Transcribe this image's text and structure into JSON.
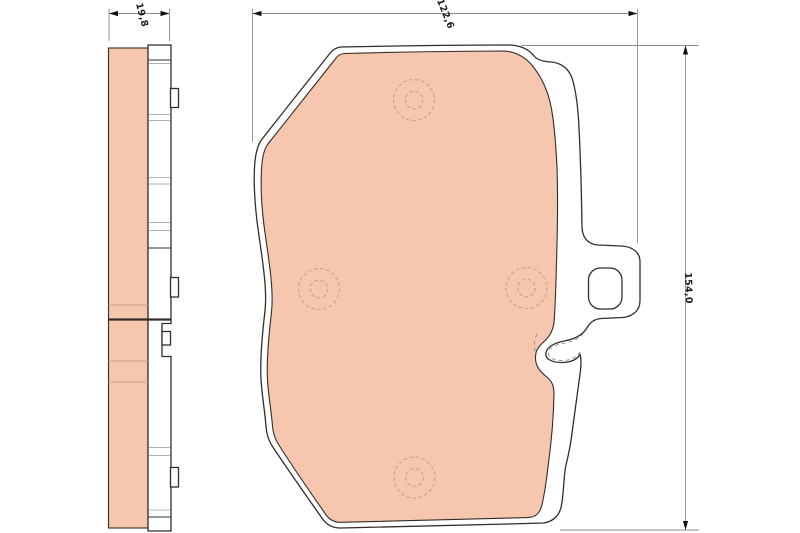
{
  "dimensions": {
    "thickness": {
      "label": "19,8"
    },
    "width": {
      "label": "122,6"
    },
    "height": {
      "label": "154,0"
    }
  },
  "colors": {
    "friction_material": "#f6c7ae",
    "outline": "#332d28",
    "dimension_line": "#8d8d8d",
    "hidden_feature_line": "#cf9d84",
    "text": "#1b1b1b",
    "background": "#ffffff"
  }
}
